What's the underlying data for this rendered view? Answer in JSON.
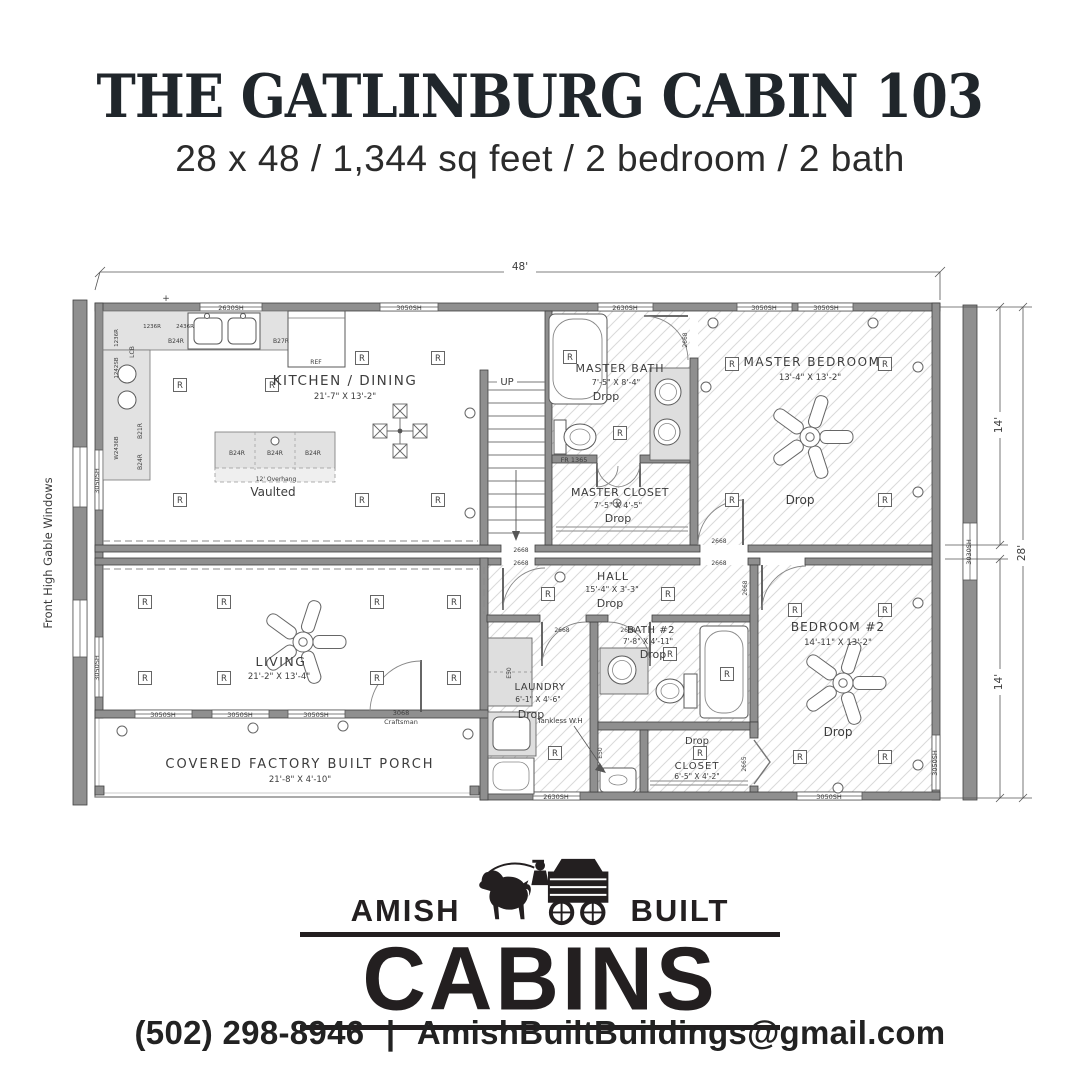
{
  "header": {
    "title": "THE GATLINBURG CABIN 103",
    "subtitle": "28 x 48 / 1,344 sq feet / 2 bedroom / 2 bath"
  },
  "plan": {
    "dims": {
      "total_width": "48'",
      "upper_depth": "14'",
      "lower_depth": "14'",
      "total_depth": "28'"
    },
    "side_note": "Front High Gable Windows",
    "plus": "+",
    "rooms": {
      "kitchen": {
        "name": "KITCHEN / DINING",
        "size": "21'-7\" X 13'-2\"",
        "ceiling": "Vaulted"
      },
      "master_bath": {
        "name": "MASTER BATH",
        "size": "7'-5\" X 8'-4\"",
        "ceiling": "Drop"
      },
      "master_closet": {
        "name": "MASTER CLOSET",
        "size": "7'-5\" X 4'-5\"",
        "ceiling": "Drop"
      },
      "master_bedroom": {
        "name": "MASTER BEDROOM",
        "size": "13'-4\" X 13'-2\"",
        "ceiling": "Drop"
      },
      "living": {
        "name": "LIVING",
        "size": "21'-2\" X 13'-4\""
      },
      "hall": {
        "name": "HALL",
        "size": "15'-4\" X 3'-3\"",
        "ceiling": "Drop"
      },
      "laundry": {
        "name": "LAUNDRY",
        "size": "6'-1\" X 4'-6\"",
        "ceiling": "Drop"
      },
      "bath2": {
        "name": "BATH #2",
        "size": "7'-8\" X 4'-11\"",
        "ceiling": "Drop"
      },
      "closet2": {
        "name": "CLOSET",
        "size": "6'-5\" X 4'-2\"",
        "ceiling": "Drop"
      },
      "bedroom2": {
        "name": "BEDROOM #2",
        "size": "14'-11\" X 13'-2\"",
        "ceiling": "Drop"
      },
      "porch": {
        "name": "COVERED FACTORY BUILT PORCH",
        "size": "21'-8\" X 4'-10\""
      }
    },
    "stairs": {
      "up": "UP"
    },
    "symbols": {
      "recessed": "R"
    },
    "windows": {
      "w2630": "2630SH",
      "w3050": "3050SH",
      "w3030": "3030SH"
    },
    "doors": {
      "d2668": "2668",
      "d2665": "2665",
      "front_size": "3068",
      "front_style": "Craftsman",
      "closet_fr": "FR 1365"
    },
    "cabinets": {
      "b24r": "B24R",
      "b21r": "B21R",
      "b27r": "B27R",
      "lcb": "LCB",
      "c1236r": "1236R",
      "c2436r": "2436R",
      "c1242sb": "1242SB",
      "w2436b": "W2436B",
      "e50": "E50",
      "ref": "REF",
      "overhang": "12' Overhang"
    },
    "notes": {
      "tankless": "Tankless W.H"
    }
  },
  "logo": {
    "left": "AMISH",
    "right": "BUILT",
    "main": "CABINS"
  },
  "footer": {
    "phone": "(502) 298-8946",
    "sep": "|",
    "email": "AmishBuiltBuildings@gmail.com"
  }
}
